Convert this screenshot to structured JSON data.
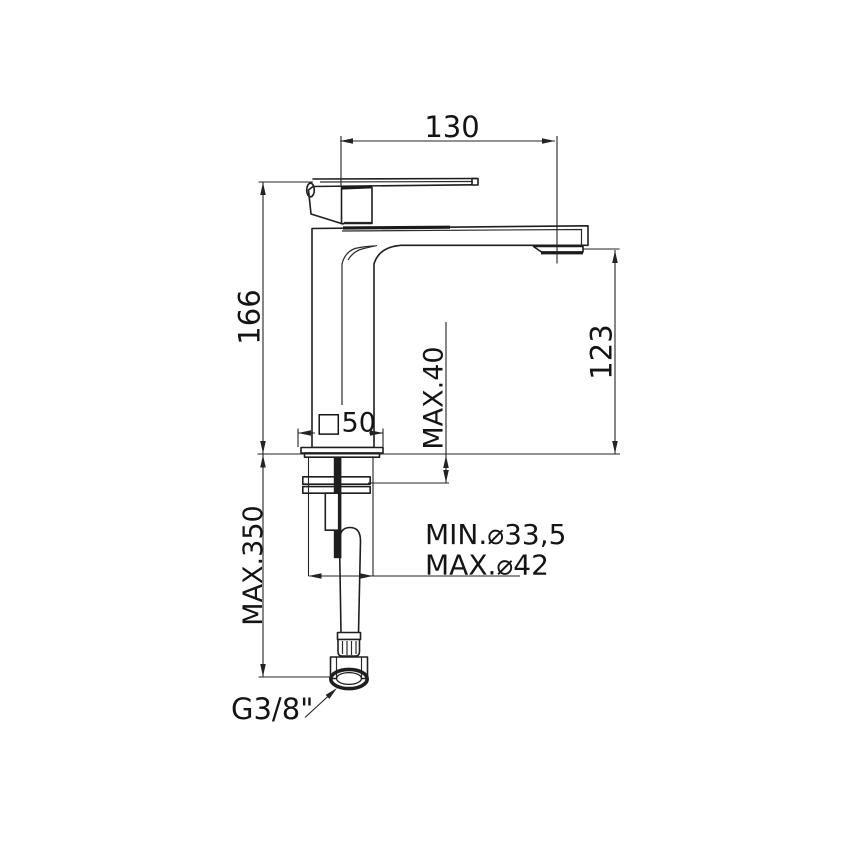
{
  "drawing": {
    "background": "#ffffff",
    "line_color": "#1e1e1e",
    "text_color": "#141414",
    "labels": {
      "spout_projection": "130",
      "height_above_deck": "166",
      "spout_outlet_height": "123",
      "max_deck_thickness": "MAX.40",
      "base_square_size": "□50",
      "max_under_deck_length": "MAX.350",
      "hole_diameter_min": "MIN.⌀33,5",
      "hole_diameter_max": "MAX.⌀42",
      "inlet_thread": "G3/8\""
    }
  }
}
